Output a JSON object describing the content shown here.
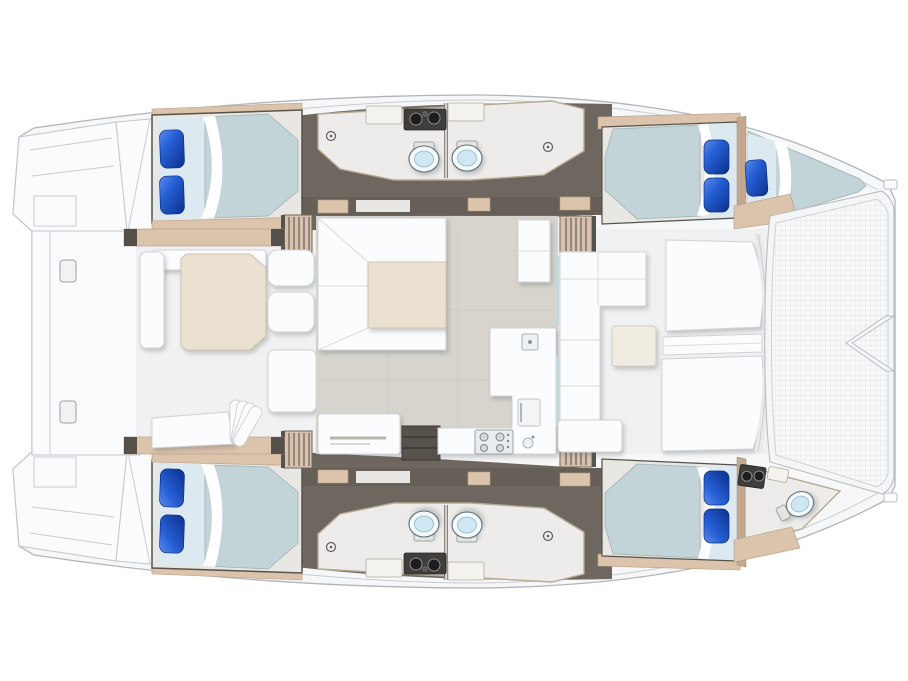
{
  "page": {
    "description": "Top-down deck and floor plan of a sailing catamaran, bow to the right, showing 4 double cabins, forepeak berth, heads, salon, galley, aft cockpit, forward cockpit and bow trampoline net"
  },
  "colors": {
    "background": "#ffffff",
    "hull": "#f6f7f8",
    "hull_line": "#b0b5ba",
    "deck": "#f0f1f2",
    "dark_floor": "#6e675f",
    "dark_band": "#665f58",
    "wood_trim": "#dcc3ac",
    "wood_trim_dark": "#c3a88f",
    "bath_floor": "#edecea",
    "salon_floor": "#d7d4cd",
    "mattress": "#c2d4d7",
    "sheet": "#dde9f1",
    "pillow_light": "#5e8cee",
    "pillow_mid": "#2760d6",
    "pillow_dark": "#0c3390",
    "table_beige": "#eae1d1",
    "furniture_white": "#fbfcfd",
    "toilet_bowl": "#cfe7f3",
    "vanity_dark": "#3f3e3c",
    "stairs_wood": "#d9c2ad",
    "net_bg": "#f7f8f9",
    "net_line": "#e4e6e8"
  },
  "legend": {
    "orientation": {
      "bow": "right",
      "stern": "left",
      "port_hull": "top",
      "starboard_hull": "bottom"
    },
    "areas": [
      {
        "name": "aft-swim-platforms",
        "location": "stern"
      },
      {
        "name": "aft-platform"
      },
      {
        "name": "aft-cockpit",
        "fixtures": [
          "dining-table",
          "bench-seat",
          "lounge-chairs",
          "fan-cushions"
        ]
      },
      {
        "name": "salon",
        "fixtures": [
          "u-shaped-settee",
          "salon-table",
          "chart-table",
          "open-shelf",
          "cabinet"
        ]
      },
      {
        "name": "galley",
        "fixtures": [
          "square-sink",
          "round-sink",
          "stove-4-burner",
          "fridge-door",
          "l-counter"
        ]
      },
      {
        "name": "forward-cockpit",
        "fixtures": [
          "l-sofa",
          "side-table",
          "sun-pads",
          "bench"
        ]
      },
      {
        "name": "trampoline-net",
        "fixtures": [
          "bowsprit-chevron"
        ]
      },
      {
        "name": "port-aft-cabin",
        "fixtures": [
          "double-bed",
          "two-pillows"
        ]
      },
      {
        "name": "port-head",
        "fixtures": [
          "toilet",
          "shower-drain",
          "vanity-twin-sinks",
          "counters"
        ]
      },
      {
        "name": "port-forward-cabin",
        "fixtures": [
          "double-bed",
          "two-pillows"
        ]
      },
      {
        "name": "port-forepeak-berth",
        "fixtures": [
          "berth",
          "one-pillow"
        ]
      },
      {
        "name": "starboard-aft-cabin",
        "fixtures": [
          "double-bed",
          "two-pillows"
        ]
      },
      {
        "name": "starboard-head",
        "fixtures": [
          "toilet",
          "shower-drain",
          "vanity-twin-sinks",
          "counters"
        ]
      },
      {
        "name": "starboard-forward-cabin",
        "fixtures": [
          "double-bed",
          "two-pillows"
        ]
      },
      {
        "name": "starboard-forepeak-head",
        "fixtures": [
          "toilet",
          "vanity-sink"
        ]
      }
    ],
    "counts": {
      "cabins": 4,
      "beds": 5,
      "pillows": 9,
      "toilets": 5,
      "companionway_stairs": 4,
      "tables": 3
    }
  }
}
